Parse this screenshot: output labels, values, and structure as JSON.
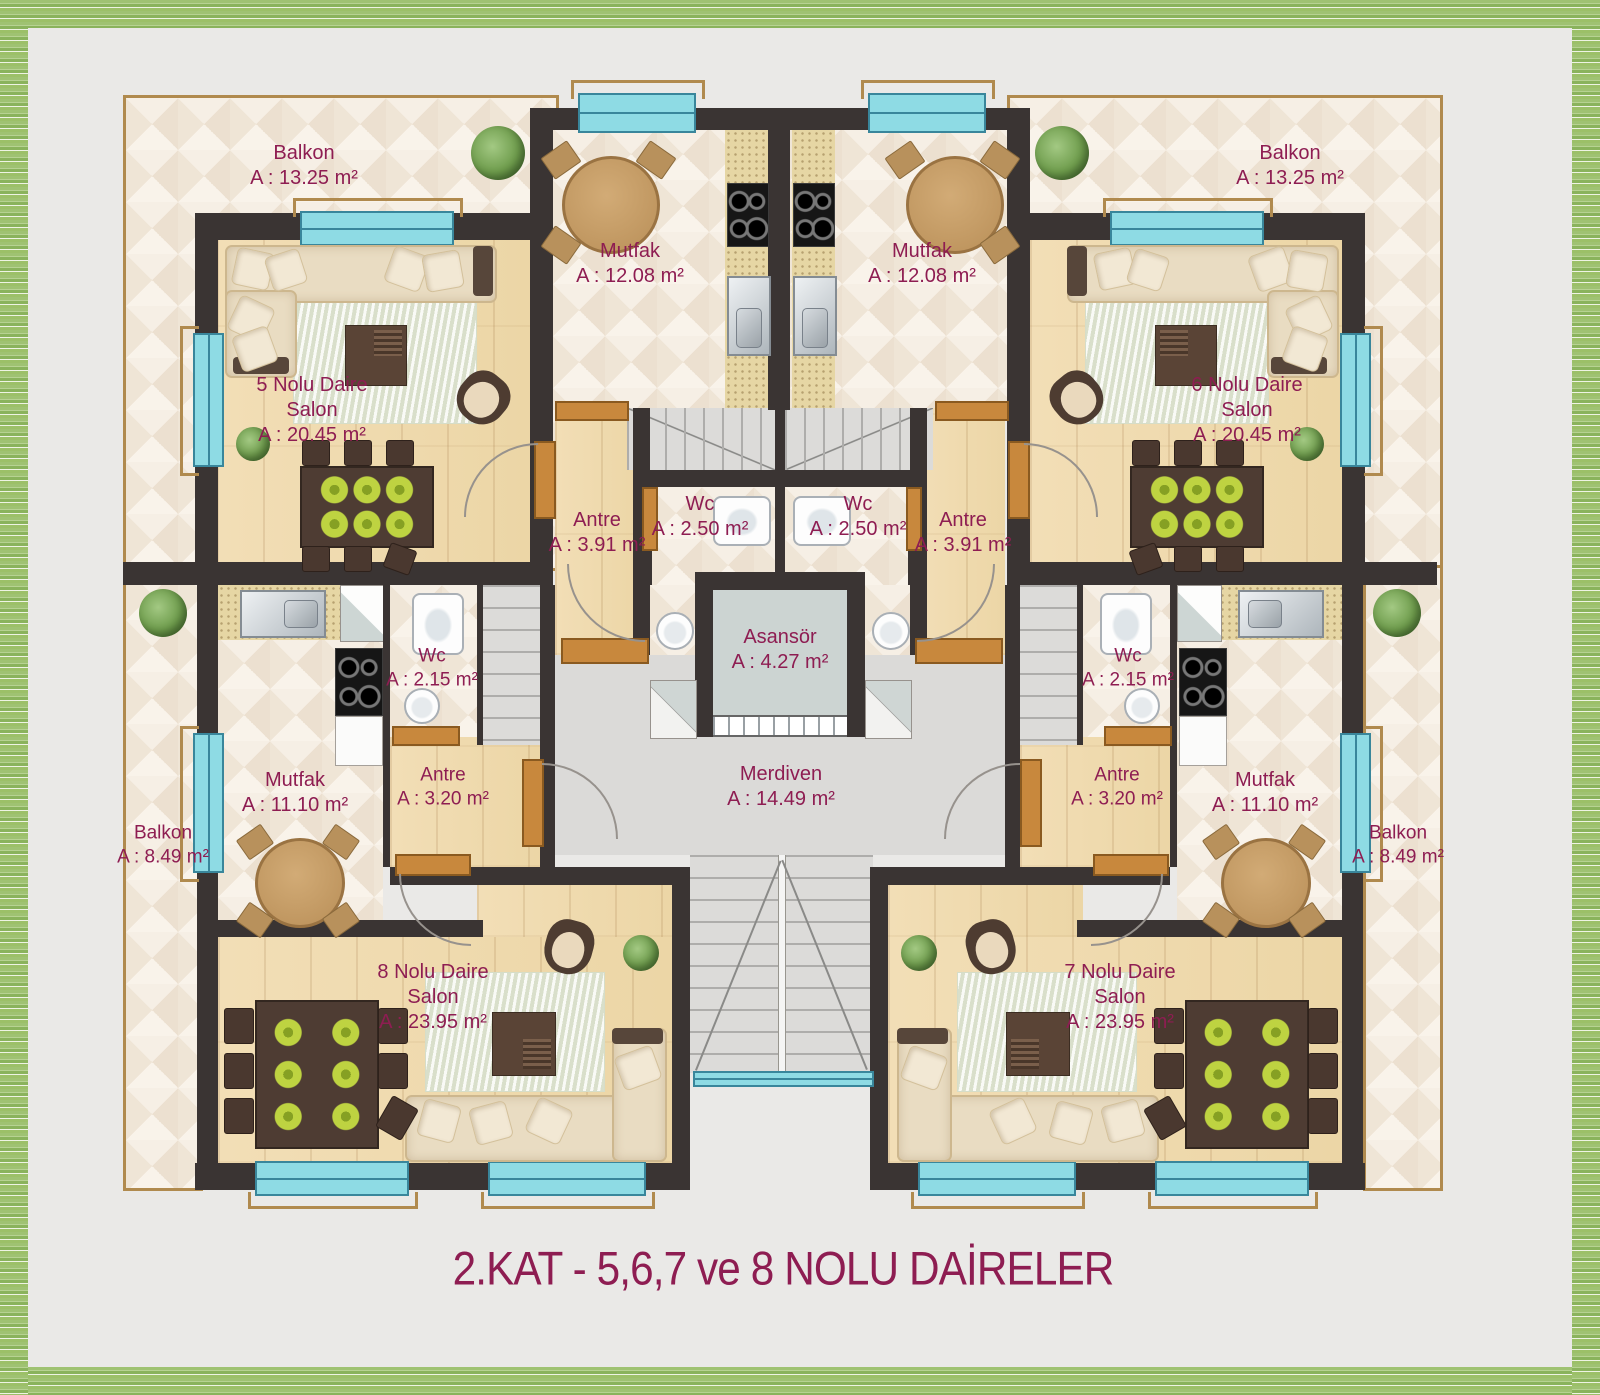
{
  "title": "2.KAT - 5,6,7 ve 8 NOLU DAİRELER",
  "colors": {
    "label_text": "#8e1d52",
    "wall": "#3a3433",
    "window": "#8edbe4",
    "door": "#c8883d",
    "frame_green": "#9cc068",
    "background": "#eae9e7"
  },
  "rooms": {
    "balkon_tl": {
      "name": "Balkon",
      "area": "A : 13.25 m²"
    },
    "balkon_tr": {
      "name": "Balkon",
      "area": "A : 13.25 m²"
    },
    "mutfak5": {
      "name": "Mutfak",
      "area": "A : 12.08 m²"
    },
    "mutfak6": {
      "name": "Mutfak",
      "area": "A : 12.08 m²"
    },
    "salon5": {
      "line1": "5 Nolu Daire",
      "line2": "Salon",
      "area": "A : 20.45 m²"
    },
    "salon6": {
      "line1": "6 Nolu Daire",
      "line2": "Salon",
      "area": "A : 20.45 m²"
    },
    "antre5": {
      "name": "Antre",
      "area": "A : 3.91 m²"
    },
    "antre6": {
      "name": "Antre",
      "area": "A : 3.91 m²"
    },
    "wc5": {
      "name": "Wc",
      "area": "A : 2.50 m²"
    },
    "wc6": {
      "name": "Wc",
      "area": "A : 2.50 m²"
    },
    "asansor": {
      "name": "Asansör",
      "area": "A : 4.27 m²"
    },
    "merdiven": {
      "name": "Merdiven",
      "area": "A : 14.49 m²"
    },
    "mutfak8": {
      "name": "Mutfak",
      "area": "A : 11.10 m²"
    },
    "mutfak7": {
      "name": "Mutfak",
      "area": "A : 11.10 m²"
    },
    "wc8": {
      "name": "Wc",
      "area": "A : 2.15 m²"
    },
    "wc7": {
      "name": "Wc",
      "area": "A : 2.15 m²"
    },
    "antre8": {
      "name": "Antre",
      "area": "A : 3.20 m²"
    },
    "antre7": {
      "name": "Antre",
      "area": "A : 3.20 m²"
    },
    "balkon8": {
      "name": "Balkon",
      "area": "A : 8.49 m²"
    },
    "balkon7": {
      "name": "Balkon",
      "area": "A : 8.49 m²"
    },
    "salon8": {
      "line1": "8 Nolu Daire",
      "line2": "Salon",
      "area": "A : 23.95 m²"
    },
    "salon7": {
      "line1": "7 Nolu Daire",
      "line2": "Salon",
      "area": "A : 23.95 m²"
    }
  }
}
